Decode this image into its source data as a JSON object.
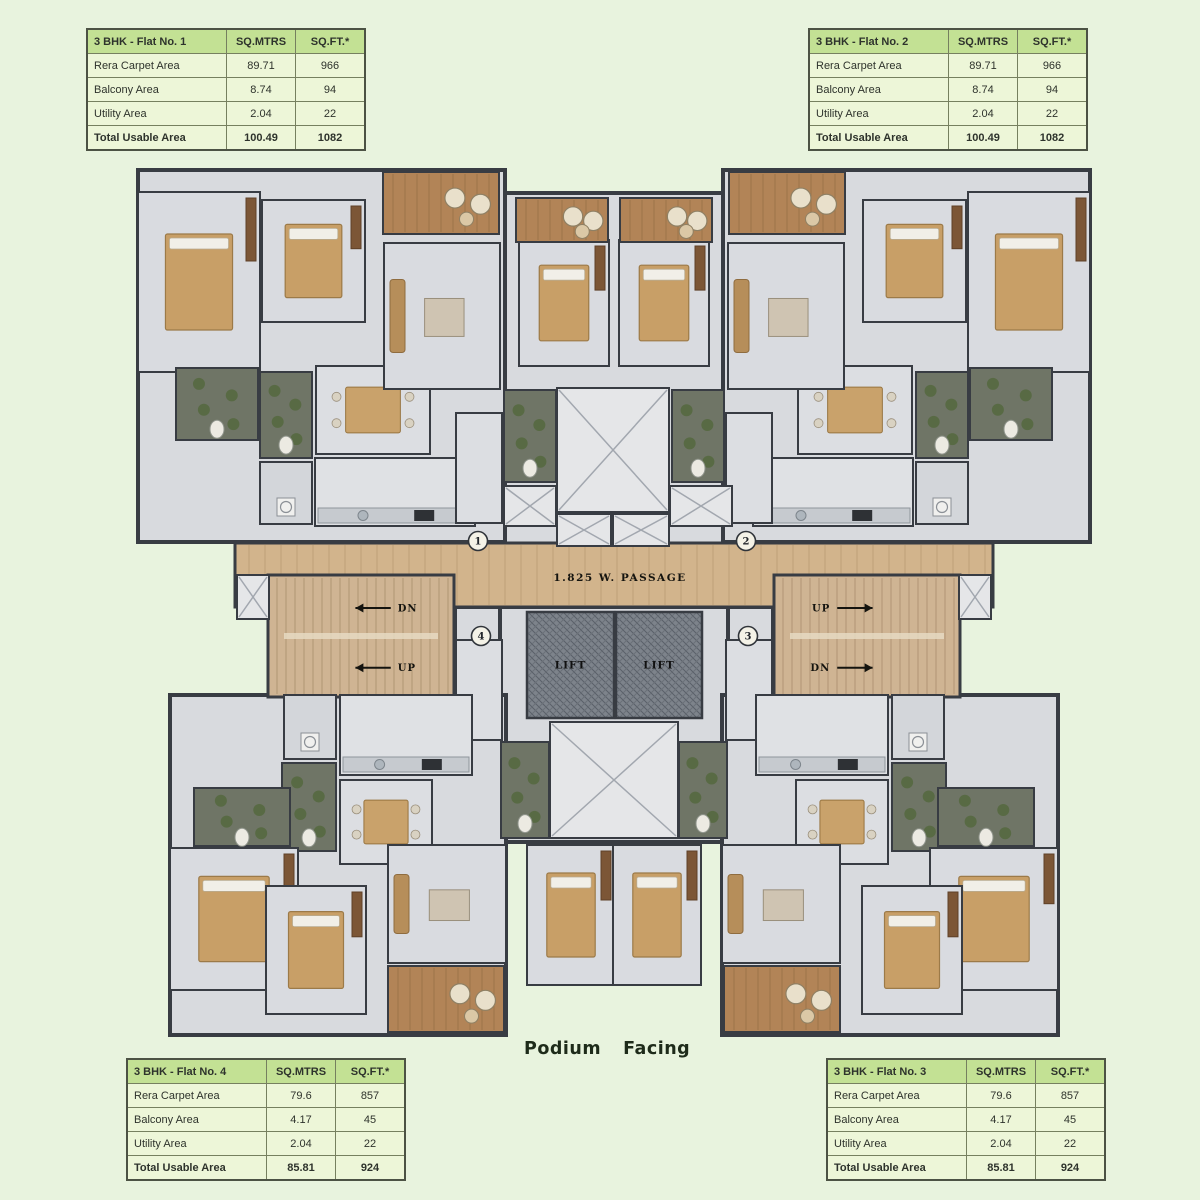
{
  "podium": {
    "word1": "Podium",
    "word2": "Facing"
  },
  "area_tables": [
    {
      "id": "flat-1",
      "left": 86,
      "top": 28,
      "title": "3 BHK - Flat No. 1",
      "col_headers": [
        "SQ.MTRS",
        "SQ.FT.*"
      ],
      "rows": [
        [
          "Rera Carpet Area",
          "89.71",
          "966"
        ],
        [
          "Balcony Area",
          "8.74",
          "94"
        ],
        [
          "Utility Area",
          "2.04",
          "22"
        ]
      ],
      "total": [
        "Total Usable Area",
        "100.49",
        "1082"
      ]
    },
    {
      "id": "flat-2",
      "left": 808,
      "top": 28,
      "title": "3 BHK - Flat No. 2",
      "col_headers": [
        "SQ.MTRS",
        "SQ.FT.*"
      ],
      "rows": [
        [
          "Rera Carpet Area",
          "89.71",
          "966"
        ],
        [
          "Balcony Area",
          "8.74",
          "94"
        ],
        [
          "Utility Area",
          "2.04",
          "22"
        ]
      ],
      "total": [
        "Total Usable Area",
        "100.49",
        "1082"
      ]
    },
    {
      "id": "flat-4",
      "left": 126,
      "top": 1058,
      "title": "3 BHK - Flat No. 4",
      "col_headers": [
        "SQ.MTRS",
        "SQ.FT.*"
      ],
      "rows": [
        [
          "Rera Carpet Area",
          "79.6",
          "857"
        ],
        [
          "Balcony Area",
          "4.17",
          "45"
        ],
        [
          "Utility Area",
          "2.04",
          "22"
        ]
      ],
      "total": [
        "Total Usable Area",
        "85.81",
        "924"
      ]
    },
    {
      "id": "flat-3",
      "left": 826,
      "top": 1058,
      "title": "3 BHK - Flat No. 3",
      "col_headers": [
        "SQ.MTRS",
        "SQ.FT.*"
      ],
      "rows": [
        [
          "Rera Carpet Area",
          "79.6",
          "857"
        ],
        [
          "Balcony Area",
          "4.17",
          "45"
        ],
        [
          "Utility Area",
          "2.04",
          "22"
        ]
      ],
      "total": [
        "Total Usable Area",
        "85.81",
        "924"
      ]
    }
  ],
  "colors": {
    "page_bg": "#e8f3de",
    "slab": "#d8dade",
    "wall": "#383c43",
    "wood": "#d2b48c",
    "wood_line": "#bfa078",
    "balcony": "#b28457",
    "stair": "#cfb493",
    "lift_bg": "#7d838b",
    "lift_line": "#5a6069",
    "duct": "#e5e6e8",
    "duct_line": "#a2a7af",
    "toilet": "#6f7566",
    "plant": "#55683e",
    "bed": "#c89f67",
    "wardrobe": "#7c5636",
    "sofa": "#b68e5a",
    "table_wood": "#c9a26b",
    "counter": "#c6cacf",
    "label": "#201f1a",
    "label_light": "#f0eedd",
    "marker_bg": "#f4f2e7"
  },
  "floor_plan": {
    "mirror_sum": 1228,
    "slabs": [
      {
        "x": 138,
        "y": 170,
        "w": 367,
        "h": 372
      },
      {
        "x": 723,
        "y": 170,
        "w": 367,
        "h": 372
      },
      {
        "x": 505,
        "y": 193,
        "w": 218,
        "h": 352
      },
      {
        "x": 455,
        "y": 607,
        "w": 50,
        "h": 140
      },
      {
        "x": 723,
        "y": 607,
        "w": 50,
        "h": 140
      },
      {
        "x": 500,
        "y": 607,
        "w": 228,
        "h": 235
      },
      {
        "x": 170,
        "y": 695,
        "w": 336,
        "h": 340
      },
      {
        "x": 722,
        "y": 695,
        "w": 336,
        "h": 340
      }
    ],
    "passage": {
      "x": 235,
      "y": 543,
      "w": 758,
      "h": 64,
      "label": "1.825 W. PASSAGE",
      "label_x": 620,
      "label_y": 581
    },
    "stairs": [
      {
        "id": "staircase-left",
        "x": 268,
        "y": 575,
        "w": 186,
        "h": 122,
        "dir": "left",
        "flights": [
          {
            "t": "DN",
            "fy": 0.27
          },
          {
            "t": "UP",
            "fy": 0.76
          }
        ]
      },
      {
        "id": "staircase-right",
        "x": 774,
        "y": 575,
        "w": 186,
        "h": 122,
        "dir": "right",
        "flights": [
          {
            "t": "UP",
            "fy": 0.27
          },
          {
            "t": "DN",
            "fy": 0.76
          }
        ]
      }
    ],
    "lifts": [
      {
        "id": "lift-1",
        "x": 527,
        "y": 612,
        "w": 87,
        "h": 106
      },
      {
        "id": "lift-2",
        "x": 616,
        "y": 612,
        "w": 86,
        "h": 106
      }
    ],
    "lift_label": "LIFT",
    "markers": [
      {
        "n": "1",
        "x": 478,
        "y": 541
      },
      {
        "n": "2",
        "x": 746,
        "y": 541
      },
      {
        "n": "4",
        "x": 481,
        "y": 636
      },
      {
        "n": "3",
        "x": 748,
        "y": 636
      }
    ],
    "rooms": [
      {
        "id": "m-bedroom-1",
        "type": "bedroom",
        "x": 138,
        "y": 192,
        "w": 122,
        "h": 180,
        "ly": 0.74,
        "mirror": true,
        "lines": [
          "M. BEDROOM",
          "3.55 X 4.45",
          "11'8\" X 14'7\""
        ]
      },
      {
        "id": "bedroom-1",
        "type": "bedroom",
        "x": 262,
        "y": 200,
        "w": 103,
        "h": 122,
        "ly": 0.46,
        "mirror": true,
        "lines": [
          "BEDROOM",
          "3.05 X 3.45",
          "10'0\" X 11'4\""
        ]
      },
      {
        "id": "m-toilet-1",
        "type": "toilet",
        "x": 176,
        "y": 368,
        "w": 82,
        "h": 72,
        "mirror": true,
        "lines": [
          "M. TOILET",
          "2.06 X 1.29",
          "6'9\" X 4'3\""
        ]
      },
      {
        "id": "toilet-1",
        "type": "toilet",
        "x": 260,
        "y": 372,
        "w": 52,
        "h": 86,
        "mirror": true,
        "lines": [
          "TOILET",
          "1.22 X 2.25",
          "4'0\" X 7'6\""
        ]
      },
      {
        "id": "utility-1",
        "type": "utility",
        "x": 260,
        "y": 462,
        "w": 52,
        "h": 62,
        "mirror": true,
        "lines": [
          "UTILITY",
          "1.36 X 1.49",
          "4'6\" X 4'11\""
        ]
      },
      {
        "id": "kitchen-1",
        "type": "kitchen",
        "x": 315,
        "y": 458,
        "w": 160,
        "h": 68,
        "lx": 0.25,
        "mirror": true,
        "lines": [
          "KITCHEN",
          "3.69 X 2.09",
          "12'1\" X 6'10\""
        ]
      },
      {
        "id": "dining-1",
        "type": "dining",
        "x": 316,
        "y": 366,
        "w": 114,
        "h": 88,
        "ly": 0.38,
        "mirror": true,
        "lines": [
          "DINING",
          "1.68 X 3.05",
          "5'6\" X 10'0\""
        ]
      },
      {
        "id": "living-1",
        "type": "living",
        "x": 384,
        "y": 243,
        "w": 116,
        "h": 146,
        "ly": 0.76,
        "mirror": true,
        "lines": [
          "LIVING",
          "3.25 X 5.80",
          "11'8\" X 19'0\""
        ]
      },
      {
        "id": "balcony-1",
        "type": "balcony",
        "x": 383,
        "y": 172,
        "w": 116,
        "h": 62,
        "lx": 0.3,
        "mirror": true,
        "lines": [
          "BALCONY",
          "3.29 X 1.16",
          "11'1\" X 3'9\""
        ],
        "lines_r": [
          "BALCONY",
          "3.29 X 1.46",
          "11'1\" X 4'9\""
        ]
      },
      {
        "id": "m-bedroom-1b",
        "type": "bedroom",
        "x": 519,
        "y": 240,
        "w": 90,
        "h": 126,
        "ly": 0.86,
        "mirror": true,
        "lines": [
          "M. BEDROOM",
          "3.10 X 3.96",
          "10'2\" X 13'0\""
        ]
      },
      {
        "id": "balcony-1b",
        "type": "balcony",
        "x": 516,
        "y": 198,
        "w": 92,
        "h": 44,
        "mirror": true,
        "lines": [
          "BALCONY",
          "3.05 X 1.27",
          "9'10\" X 4'2\""
        ]
      },
      {
        "id": "ent-lobby-1",
        "type": "lobby",
        "x": 456,
        "y": 413,
        "w": 46,
        "h": 110,
        "mirror": true,
        "lines": [
          "ENT.",
          "LOBBY",
          "1.20 X 2.25",
          "4'0\" X 7'6\""
        ]
      },
      {
        "id": "m-toilet-c1",
        "type": "toilet",
        "x": 504,
        "y": 390,
        "w": 52,
        "h": 92,
        "mirror": true,
        "lines": [
          "M. TOILET",
          "1.29 X 2.18",
          "4'3\" X 7'2\""
        ]
      },
      {
        "id": "duct-top",
        "type": "duct",
        "x": 557,
        "y": 388,
        "w": 112,
        "h": 124,
        "lines": [
          "DUCT"
        ]
      },
      {
        "id": "duct-small-left",
        "type": "duct",
        "x": 504,
        "y": 486,
        "w": 52,
        "h": 40,
        "lines": [
          "DUCT"
        ]
      },
      {
        "id": "ff-duct",
        "type": "duct",
        "x": 670,
        "y": 486,
        "w": 62,
        "h": 40,
        "lines": [
          "F.F. DUCT"
        ]
      },
      {
        "id": "ele-duct",
        "type": "duct",
        "x": 557,
        "y": 514,
        "w": 54,
        "h": 32,
        "lines": [
          "ELE.",
          "DUCT"
        ]
      },
      {
        "id": "lv-duct",
        "type": "duct",
        "x": 613,
        "y": 514,
        "w": 56,
        "h": 32,
        "lines": [
          "LV DUCT"
        ]
      },
      {
        "id": "duct-passage-end",
        "type": "duct",
        "x": 237,
        "y": 575,
        "w": 32,
        "h": 44,
        "lines": [],
        "mirror": true
      },
      {
        "id": "ent-lobby-4",
        "type": "lobby",
        "x": 456,
        "y": 640,
        "w": 46,
        "h": 100,
        "mirror": true,
        "lines": [
          "ENT.",
          "LOBBY+",
          "1.20 X 2.40",
          "4'0\" X 7'11\""
        ]
      },
      {
        "id": "m-toilet-c4",
        "type": "toilet",
        "x": 501,
        "y": 742,
        "w": 48,
        "h": 96,
        "mirror": true,
        "lines": [
          "M. TOILET",
          "1.29 X 2.18",
          "4'3\" X 7'2\""
        ]
      },
      {
        "id": "duct-bottom",
        "type": "duct",
        "x": 550,
        "y": 722,
        "w": 128,
        "h": 116,
        "lines": [
          "DUCT"
        ]
      },
      {
        "id": "utility-4",
        "type": "utility",
        "x": 284,
        "y": 695,
        "w": 52,
        "h": 64,
        "mirror": true,
        "lines": [
          "UTILITY",
          "1.36 X 1.49",
          "4'6\" X 4'11\""
        ]
      },
      {
        "id": "kitchen-4",
        "type": "kitchen",
        "x": 340,
        "y": 695,
        "w": 132,
        "h": 80,
        "lx": 0.3,
        "mirror": true,
        "lines": [
          "KITCHEN",
          "3.08 X 2.09",
          "10'1\" X 6'10\""
        ]
      },
      {
        "id": "toilet-4",
        "type": "toilet",
        "x": 282,
        "y": 763,
        "w": 54,
        "h": 88,
        "mirror": true,
        "lines": [
          "TOILET",
          "1.22 X 2.25",
          "4'0\" X 7'6\""
        ]
      },
      {
        "id": "dining-4",
        "type": "dining",
        "x": 340,
        "y": 780,
        "w": 92,
        "h": 84,
        "mirror": true,
        "lines": [
          "DINING",
          "1.37 X 3.05",
          "4'6\" X 10'0\""
        ]
      },
      {
        "id": "m-toilet-4",
        "type": "toilet",
        "x": 194,
        "y": 788,
        "w": 96,
        "h": 58,
        "mirror": true,
        "lines": [
          "M. TOILET",
          "2.06 X 1.29",
          "6'9\" X 4'3\""
        ]
      },
      {
        "id": "m-bedroom-4",
        "type": "bedroom",
        "x": 170,
        "y": 848,
        "w": 128,
        "h": 142,
        "ly": 0.27,
        "mirror": true,
        "lines": [
          "M. BEDROOM",
          "3.05 X 3.95",
          "10'0\" X 13'0\""
        ]
      },
      {
        "id": "bedroom-4",
        "type": "bedroom",
        "x": 266,
        "y": 886,
        "w": 100,
        "h": 128,
        "ly": 0.6,
        "mirror": true,
        "lines": [
          "BEDROOM",
          "2.74 X 3.45",
          "9'0\" X 11'4\""
        ]
      },
      {
        "id": "living-4",
        "type": "living",
        "x": 388,
        "y": 845,
        "w": 118,
        "h": 118,
        "ly": 0.15,
        "mirror": true,
        "lines": [
          "LIVING",
          "3.05 X 5.20",
          "10'0\" X 17'1\""
        ]
      },
      {
        "id": "balcony-4",
        "type": "balcony",
        "x": 388,
        "y": 966,
        "w": 116,
        "h": 66,
        "mirror": true,
        "lines": [
          "BALCONY",
          "3.09 X 1.21",
          "10'2\" X 4'0\""
        ],
        "lines_r": [
          "BALCONY",
          "3.09 X 1.34",
          "10'2\" X 4'5\""
        ]
      },
      {
        "id": "m-bedroom-4b",
        "type": "bedroom",
        "x": 527,
        "y": 845,
        "w": 88,
        "h": 140,
        "ly": 0.15,
        "mirror": true,
        "lines": [
          "M. BEDROOM",
          "3.10 X 3.45",
          "10'2\" X 11'4\""
        ]
      },
      {
        "id": "passage-label-1",
        "type": "text",
        "x": 345,
        "y": 349,
        "mirror": true,
        "lines": [
          "3'0\" WIDE",
          "PASSAGE"
        ]
      },
      {
        "id": "passage-label-4",
        "type": "text",
        "x": 352,
        "y": 866,
        "mirror": true,
        "lines": [
          "3'0\" WIDE",
          "PASSAGE"
        ]
      }
    ]
  }
}
